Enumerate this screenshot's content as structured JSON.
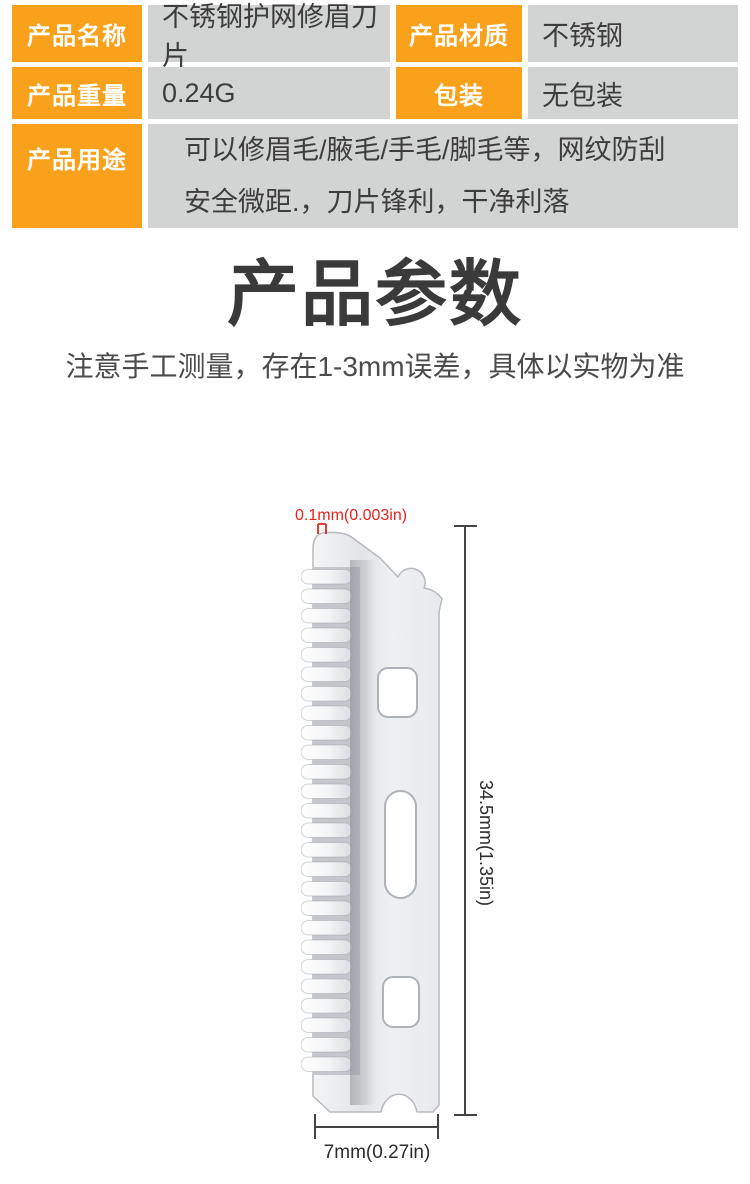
{
  "spec_table": {
    "rows": [
      {
        "label": "产品名称",
        "value": "不锈钢护网修眉刀片",
        "label2": "产品材质",
        "value2": "不锈钢"
      },
      {
        "label": "产品重量",
        "value": "0.24G",
        "label2": "包装",
        "value2": "无包装"
      },
      {
        "label": "产品用途",
        "value_lines": [
          "可以修眉毛/腋毛/手毛/脚毛等，网纹防刮",
          "安全微距.，刀片锋利，干净利落"
        ]
      }
    ]
  },
  "section": {
    "title": "产品参数",
    "note": "注意手工测量，存在1-3mm误差，具体以实物为准"
  },
  "diagram": {
    "thickness_label": "0.1mm(0.003in)",
    "height_label": "34.5mm(1.35in)",
    "width_label": "7mm(0.27in)"
  },
  "colors": {
    "accent_orange": "#F9A11B",
    "cell_gray": "#D2D3D3",
    "annotation_red": "#E8231C",
    "dimension_line": "#444444",
    "title_text": "#3A3A3A"
  }
}
